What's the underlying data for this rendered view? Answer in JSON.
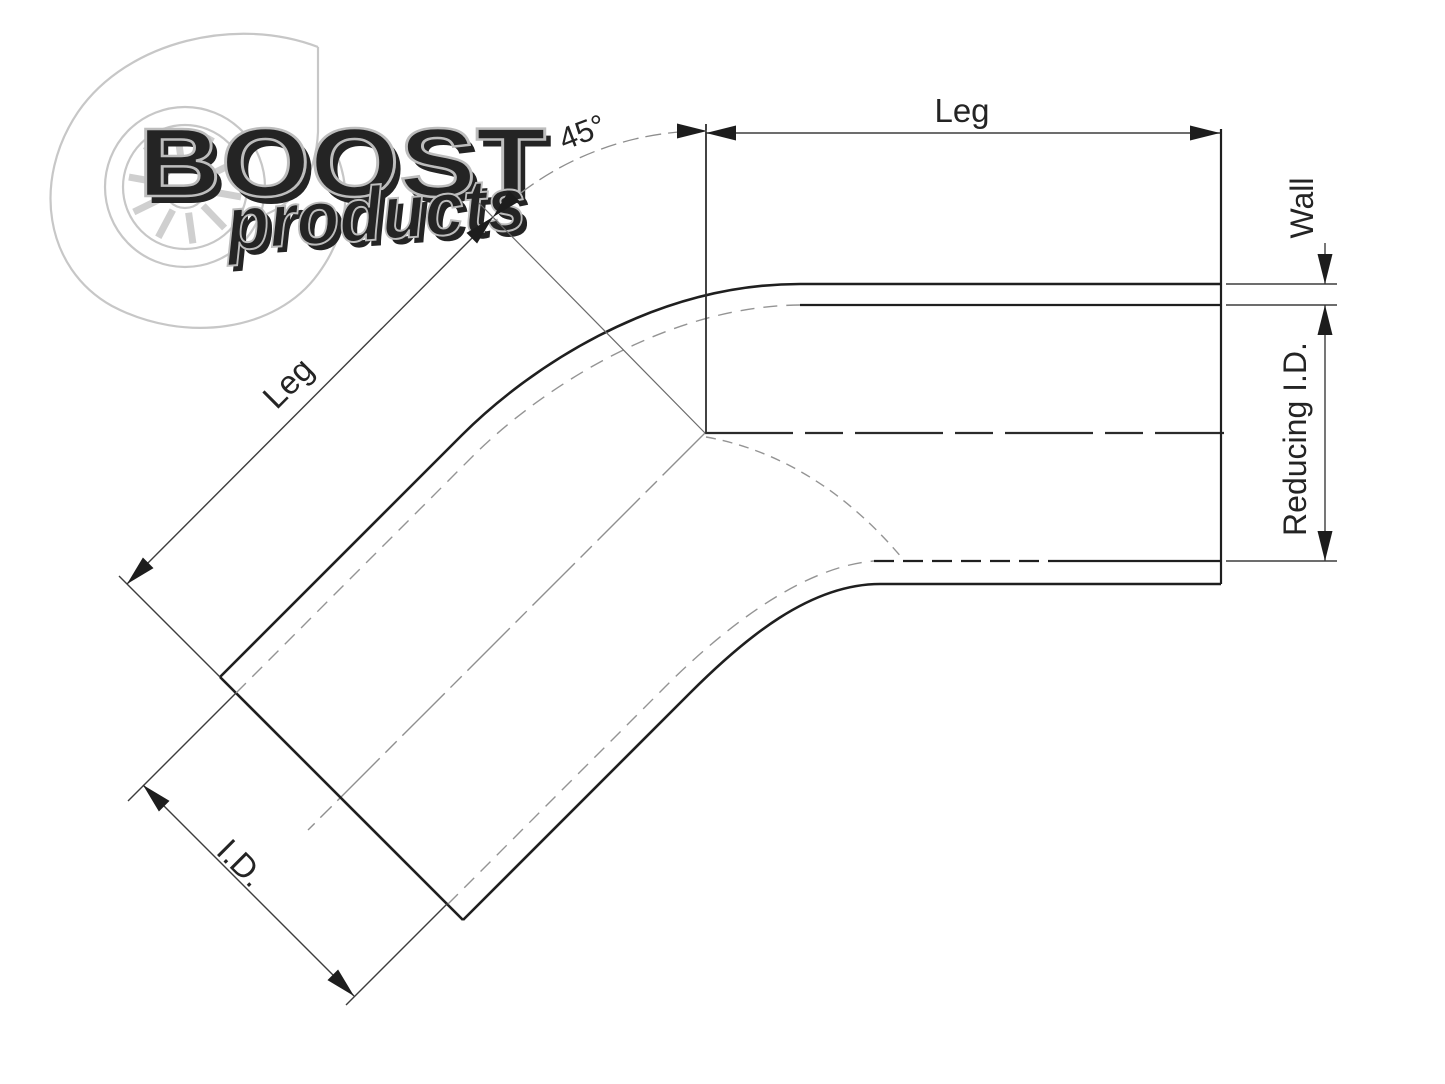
{
  "title": "45 degree reducing elbow technical drawing",
  "logo": {
    "brand": "BOOST",
    "sub": "products"
  },
  "labels": {
    "leg_top": "Leg",
    "leg_diagonal": "Leg",
    "angle": "45°",
    "wall": "Wall",
    "reducing_id": "Reducing I.D.",
    "inner_diameter": "I.D."
  },
  "colors": {
    "background": "#ffffff",
    "object_line": "#1f1f1f",
    "dimension_line": "#3d3d3d",
    "hidden_line": "#949494",
    "watermark": "#c7c7c7",
    "text": "#242424"
  }
}
